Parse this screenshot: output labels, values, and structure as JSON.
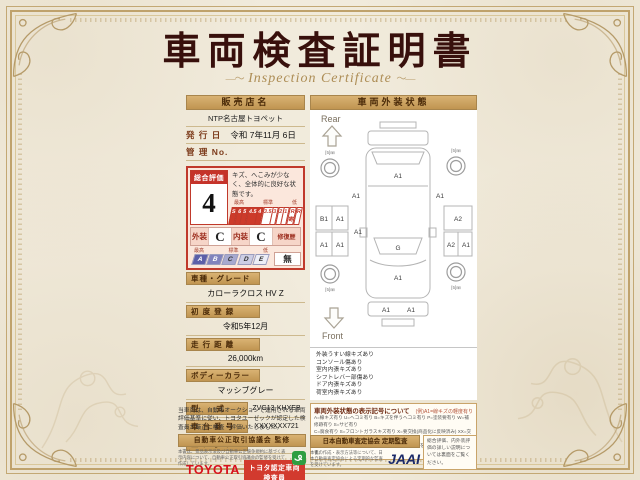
{
  "page": {
    "title": "車両検査証明書",
    "subtitle": "Inspection Certificate"
  },
  "left": {
    "dealer_header": "販売店名",
    "dealer_name": "NTP名古屋トヨペット",
    "issue_label": "発 行 日",
    "issue_value": "令和 7年11月 6日",
    "manage_label": "管 理 No.",
    "manage_value": "",
    "eval": {
      "header": "総合評価",
      "grade": "4",
      "comment": "キズ、へこみが少なく、全体的に良好な状態です。",
      "marker_high": "最高",
      "marker_mid": "標準",
      "marker_low": "低",
      "scale": [
        "S",
        "6",
        "5",
        "4.5",
        "4",
        "3.5",
        "3",
        "2",
        "1",
        "R寄",
        "R"
      ],
      "exterior_label": "外装",
      "exterior_grade": "C",
      "interior_label": "内装",
      "interior_grade": "C",
      "repair_label": "修復歴",
      "repair_value": "無",
      "letters": [
        "A",
        "B",
        "C",
        "D",
        "E"
      ]
    },
    "fields": [
      {
        "label": "車種・グレード",
        "value": "カローラクロス HV Z"
      },
      {
        "label": "初 度 登 録",
        "value": "令和5年12月"
      },
      {
        "label": "走 行 距 離",
        "value": "26,000km"
      },
      {
        "label": "ボディーカラー",
        "value": "マッシブグレー"
      },
      {
        "label": "型　　式",
        "value": "ZVG13-KHXEB"
      },
      {
        "label": "車 台 番 号",
        "value": "XXXXXXX721"
      },
      {
        "label": "エ ン ジ ン",
        "value": "ハイブリッド"
      }
    ],
    "toyota_wordmark": "TOYOTA",
    "inspector_badge": "トヨタ認定車両検査員",
    "inspector_id": "XXXXXX"
  },
  "right": {
    "header": "車両外装状態",
    "diagram": {
      "rear_label": "Rear",
      "front_label": "Front",
      "tire_tread": "[5]㎜",
      "zones": {
        "rear_gate": "A1",
        "left_quarter": "A1",
        "right_quarter": "A1",
        "left_rear_door_outer": "B1",
        "left_rear_door_inner": "A1",
        "left_front_door_outer": "A1",
        "left_front_door_inner": "A1",
        "left_body_side": "A1",
        "right_rear_door": "A2",
        "right_front_door": "A2",
        "right_front_fender": "A1",
        "windshield": "G",
        "hood": "A1",
        "front_bumper_left": "A1",
        "front_bumper_right": "A1"
      }
    },
    "notes": [
      "外装うすい線キズあり",
      "コンソール傷あり",
      "室内内張キズあり",
      "シフトレバー部傷あり",
      "ドア内張キズあり",
      "荷室内張キズあり"
    ],
    "legend": {
      "title": "車両外装状態の表示記号について",
      "example": "(例)A1=線キズの軽度有り",
      "lines": [
        "A=線キズ有り U=ヘコミ有り B=キズを伴うヘコミ有り P=塗装要有り W=補修跡有り S=サビ有り",
        "C=腐食有り S=フロントガラスキズ有り X=要交換(商品化に反映済み) XX=交換済み",
        "1=小程度 2=中程度 3=中程度以上 ※タイヤ溝は残溝を㎜であらわしています。"
      ]
    }
  },
  "bottom": {
    "disclaimer": "当車両は、自動車オークションで運用される車両評価基準に従い、トヨタユーゼックが認定した検査員が厳正に検査・評価いたしました。",
    "fair_trade_header": "自動車公正取引協議会 監修",
    "fair_trade_text": "本書は、景品表示法及び自動車公正競争規約に基づく表示内容について、自動車公正取引協議会の監修を受けて作成しています。",
    "assessor_header": "日本自動車査定協会 定期監査",
    "assessor_text": "本書の作成・表示方法等について、日本自動車査定協会による定期的な監査を受けています。",
    "jaai_logo": "JAAI",
    "back_note": "総合評価、内外装評価の詳しい説明については裏面をご覧ください。"
  },
  "colors": {
    "accent_red": "#c43a2a",
    "toyota_red": "#d8101c",
    "gold": "#b1935c",
    "tan_header": "#c9a25f",
    "jaai_navy": "#1c2a68",
    "eco_green": "#2f9e41"
  }
}
